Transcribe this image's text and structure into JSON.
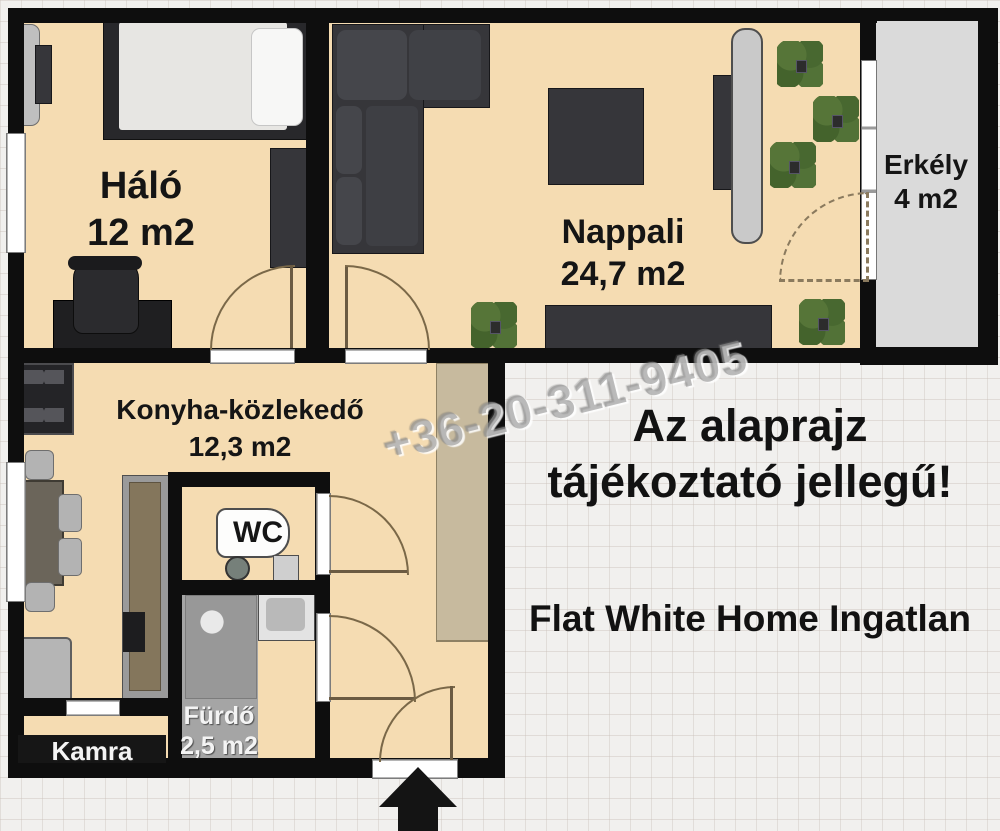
{
  "plan_title": "apartment-floor-plan",
  "rooms": [
    {
      "name": "Háló",
      "area": "12 m2"
    },
    {
      "name": "Nappali",
      "area": "24,7 m2"
    },
    {
      "name": "Erkély",
      "area": "4 m2"
    },
    {
      "name": "Konyha-közlekedő",
      "area": "12,3 m2"
    },
    {
      "name": "WC",
      "area": ""
    },
    {
      "name": "Fürdő",
      "area": "2,5 m2"
    },
    {
      "name": "Kamra",
      "area": ""
    }
  ],
  "annotations": {
    "watermark": "+36-20-311-9405",
    "disclaimer_line1": "Az alaprajz",
    "disclaimer_line2": "tájékoztató jellegű!",
    "agency": "Flat White Home Ingatlan"
  },
  "colors": {
    "floor": "#f5dcb2",
    "wall": "#0e0e0e",
    "balcony_floor": "#dadada",
    "bath_floor": "#a5a5a5",
    "furniture_dark": "#36363a",
    "wardrobe_tan": "#c7ba9e",
    "plant_green": "#44632c"
  }
}
